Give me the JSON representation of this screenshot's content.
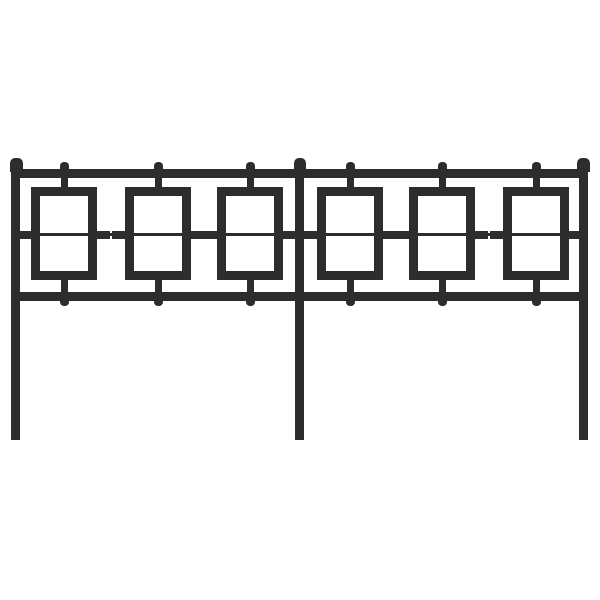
{
  "scene": {
    "description": "Black metal headboard with six rectangular geometric panels, front view product photo on white background",
    "background_color": "#ffffff"
  },
  "headboard": {
    "metal_color": "#2d2d2f",
    "canvas": {
      "width": 600,
      "height": 600
    },
    "top_rail": {
      "x": 11,
      "y": 169,
      "width": 577,
      "height": 9
    },
    "middle_rail": {
      "x": 14,
      "y": 233,
      "width": 572,
      "height": 3
    },
    "bottom_rail": {
      "x": 11,
      "y": 292,
      "width": 577,
      "height": 9
    },
    "leg": {
      "width": 9,
      "top": 166,
      "bottom": 440
    },
    "cap": {
      "y": 158,
      "height": 14
    },
    "legs": [
      {
        "name": "left",
        "x": 11,
        "cap_x": 10,
        "cap_width": 13
      },
      {
        "name": "center",
        "x": 295,
        "cap_x": 294,
        "cap_width": 12
      },
      {
        "name": "right",
        "x": 579,
        "cap_x": 577,
        "cap_width": 13
      }
    ],
    "panels": {
      "count": 6,
      "centers": [
        64,
        158,
        250,
        350,
        442,
        536
      ],
      "y": 187,
      "width": 66,
      "height": 93,
      "bar_thickness": 9,
      "top_stub": {
        "width": 7,
        "y": 176,
        "height": 13
      },
      "bottom_stub": {
        "width": 7,
        "y": 278,
        "height": 16
      },
      "side_stub": {
        "height": 8,
        "y": 231,
        "length": 15,
        "overlap": 2
      },
      "top_nub": {
        "width": 9,
        "y": 162,
        "height": 8
      },
      "bottom_nub": {
        "width": 9,
        "y": 297,
        "height": 9
      }
    }
  }
}
